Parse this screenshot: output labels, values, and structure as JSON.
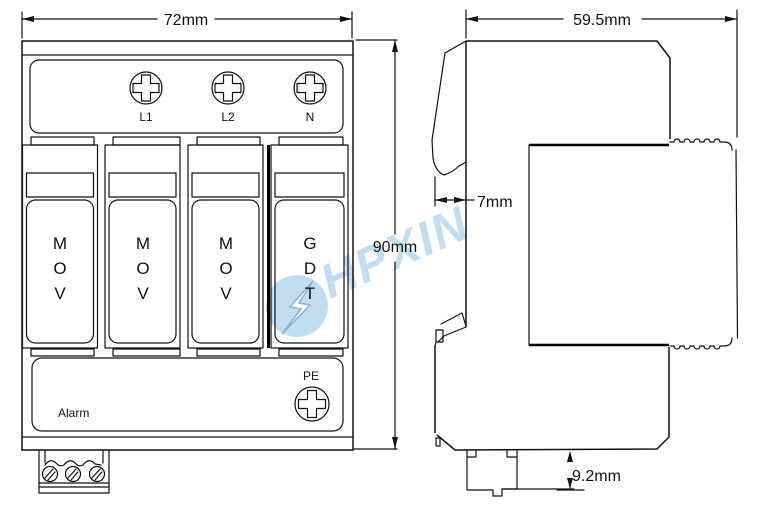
{
  "drawing": {
    "front_view": {
      "width_dim": "72mm",
      "height_dim": "90mm",
      "terminal_labels": [
        "L1",
        "L2",
        "N"
      ],
      "modules": [
        "MOV",
        "MOV",
        "MOV",
        "GDT"
      ],
      "alarm_label": "Alarm",
      "pe_label": "PE"
    },
    "side_view": {
      "depth_dim": "59.5mm",
      "flange_dim": "7mm",
      "rail_depth_dim": "9.2mm"
    },
    "watermark": {
      "text": "HPXIN",
      "color": "#bcd9ef",
      "bolt_outline": "#7fa8d0",
      "line_color": "#111111"
    }
  }
}
